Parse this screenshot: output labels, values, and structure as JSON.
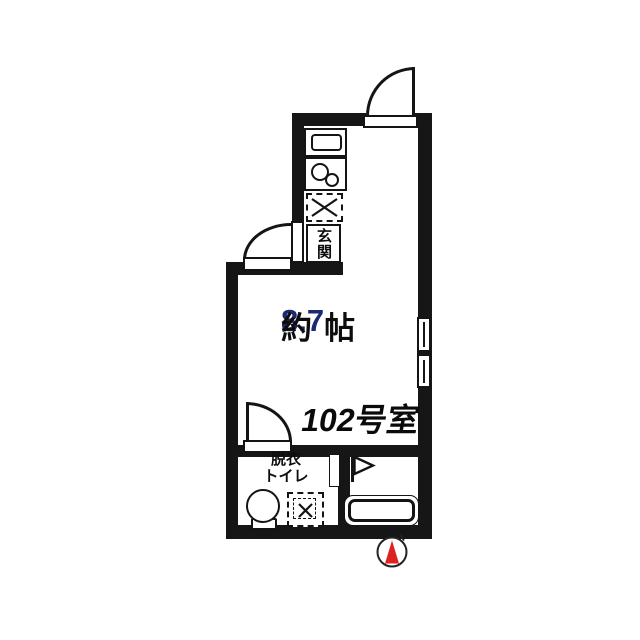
{
  "title": "Japanese apartment floor plan - room 102",
  "colors": {
    "wall": "#161616",
    "background": "#ffffff",
    "compass_red": "#dd2222",
    "text": "#0d0d0d",
    "size_value": "#1b2a70"
  },
  "labels": {
    "room_size": {
      "prefix": "約",
      "value": "8.7",
      "unit": "帖"
    },
    "room_number": "102号室",
    "entrance": "玄関",
    "dressing_line1": "脱衣",
    "dressing_line2": "トイレ"
  },
  "compass": {
    "direction": "N",
    "shape": "red-triangle-in-circle"
  },
  "symbols": {
    "entry_door": "door-swing-arc",
    "entrance_door": "door-swing-arc",
    "dressing_room_door": "door-swing-arc",
    "bath_door": "sliding-leaf",
    "kitchen_counter": "counter-top-view",
    "kitchen_sink": "sink-two-bowls",
    "washing_machine_space_kitchen": "dashed-box-with-x",
    "washing_machine_space_dressing": "dashed-box-with-x",
    "toilet": "toilet-top-view",
    "bathtub": "bathtub-top-view",
    "window": "double-pane-window-right-wall",
    "flag_marker": "pennant-flag"
  }
}
